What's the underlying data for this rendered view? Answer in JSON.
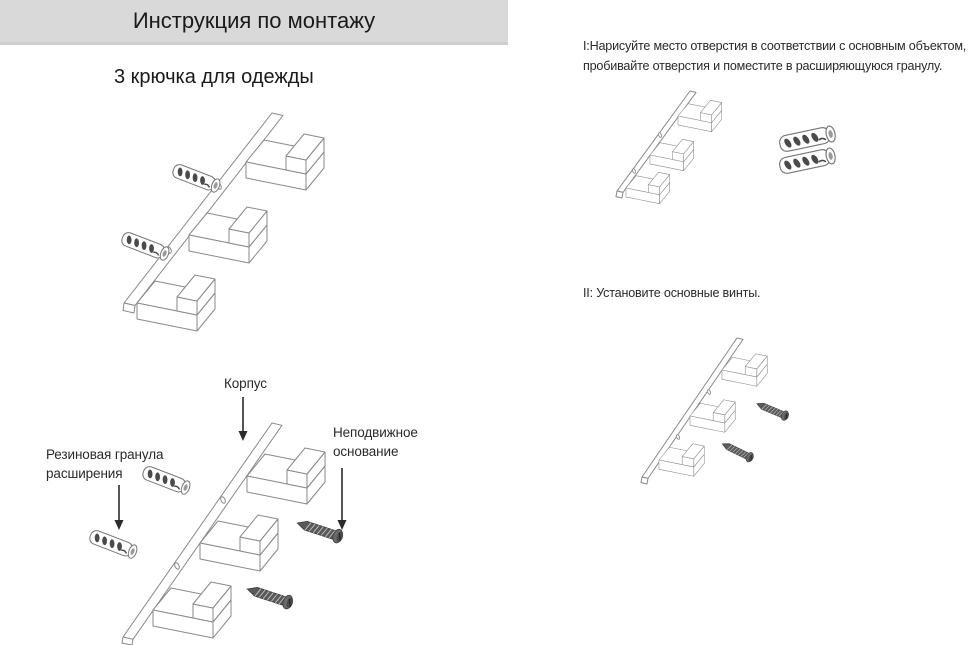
{
  "header": {
    "title": "Инструкция по монтажу"
  },
  "product": {
    "subtitle": "3 крючка для одежды"
  },
  "part_labels": {
    "body": "Корпус",
    "expansion_plug": "Резиновая гранула расширения",
    "fixed_base": "Неподвижное основание"
  },
  "steps": [
    {
      "lines": [
        "I:Нарисуйте место отверстия в соответствии с основным объектом,",
        "пробивайте отверстия и поместите в расширяющуюся гранулу."
      ]
    },
    {
      "lines": [
        "II: Установите основные винты."
      ]
    }
  ],
  "colors": {
    "header_bg": "#d9d9d9",
    "line_art": "#8a8a8a",
    "screw": "#5a5a5a",
    "arrow": "#2b2b2b",
    "text": "#262626"
  }
}
